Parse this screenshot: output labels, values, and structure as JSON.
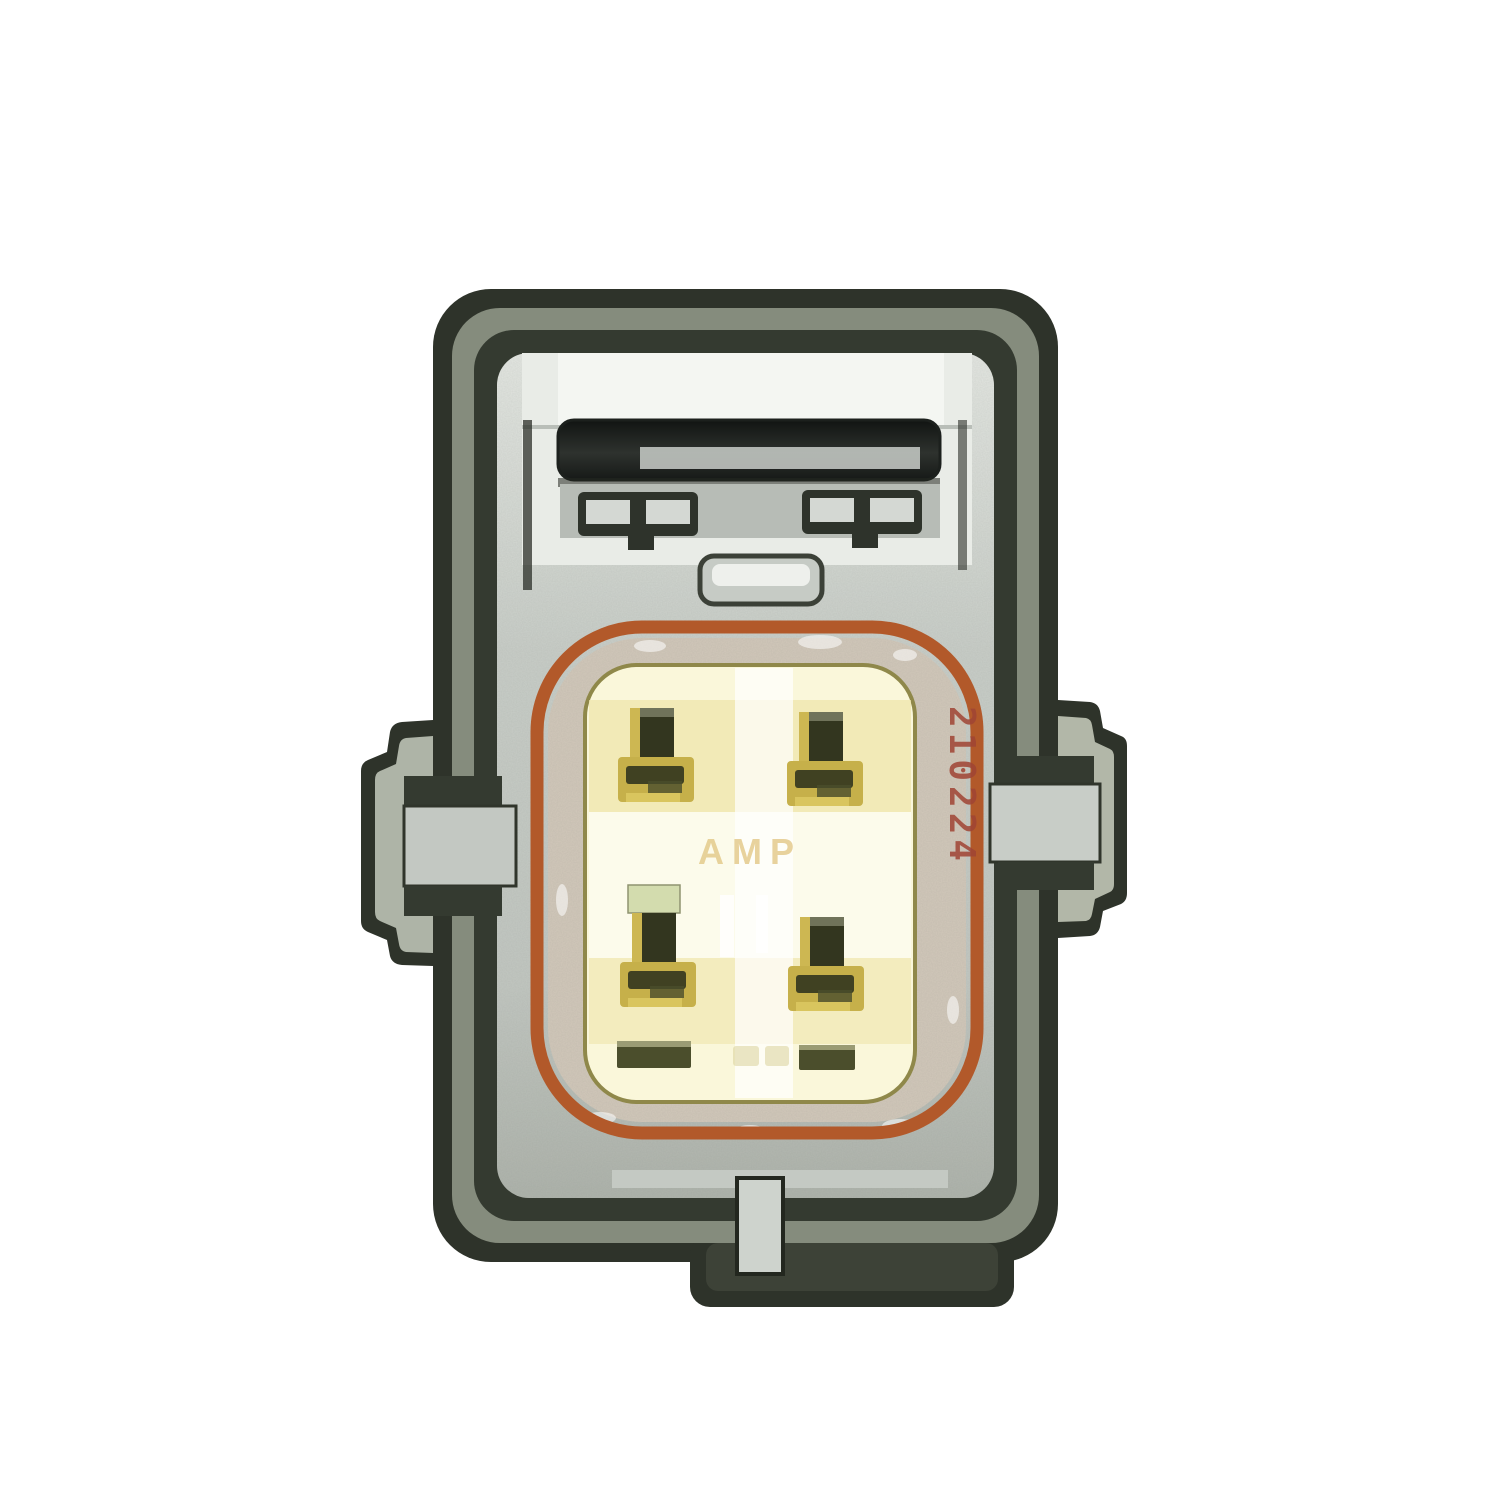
{
  "photo": {
    "subject": "Face view photograph of a 4-pin automotive electrical connector",
    "background": "#ffffff"
  },
  "connector": {
    "pin_count": "4",
    "pin_layout": "2 x 2",
    "markings": {
      "side_code": "210224",
      "brand": "AMP"
    },
    "colors": {
      "housing_dark": "#2e332a",
      "housing_band": "#858c7d",
      "housing_inner": "#343a30",
      "metal_silver": "#c6cbc5",
      "metal_bright": "#eef0ec",
      "cavity_white": "#f4f6f2",
      "latch_dark": "#1c201d",
      "seal_orange": "#b2592a",
      "seal_band": "#d2c8ba",
      "face_cream": "#faf7da",
      "face_band": "#efe5ab",
      "pin_gold": "#c6b04a",
      "pin_dark": "#33361f",
      "pin_cap_green": "#d3dcae",
      "slot_olive": "#4b4e2c",
      "marking_red": "#a04434",
      "brand_faint": "#e3c887"
    }
  }
}
